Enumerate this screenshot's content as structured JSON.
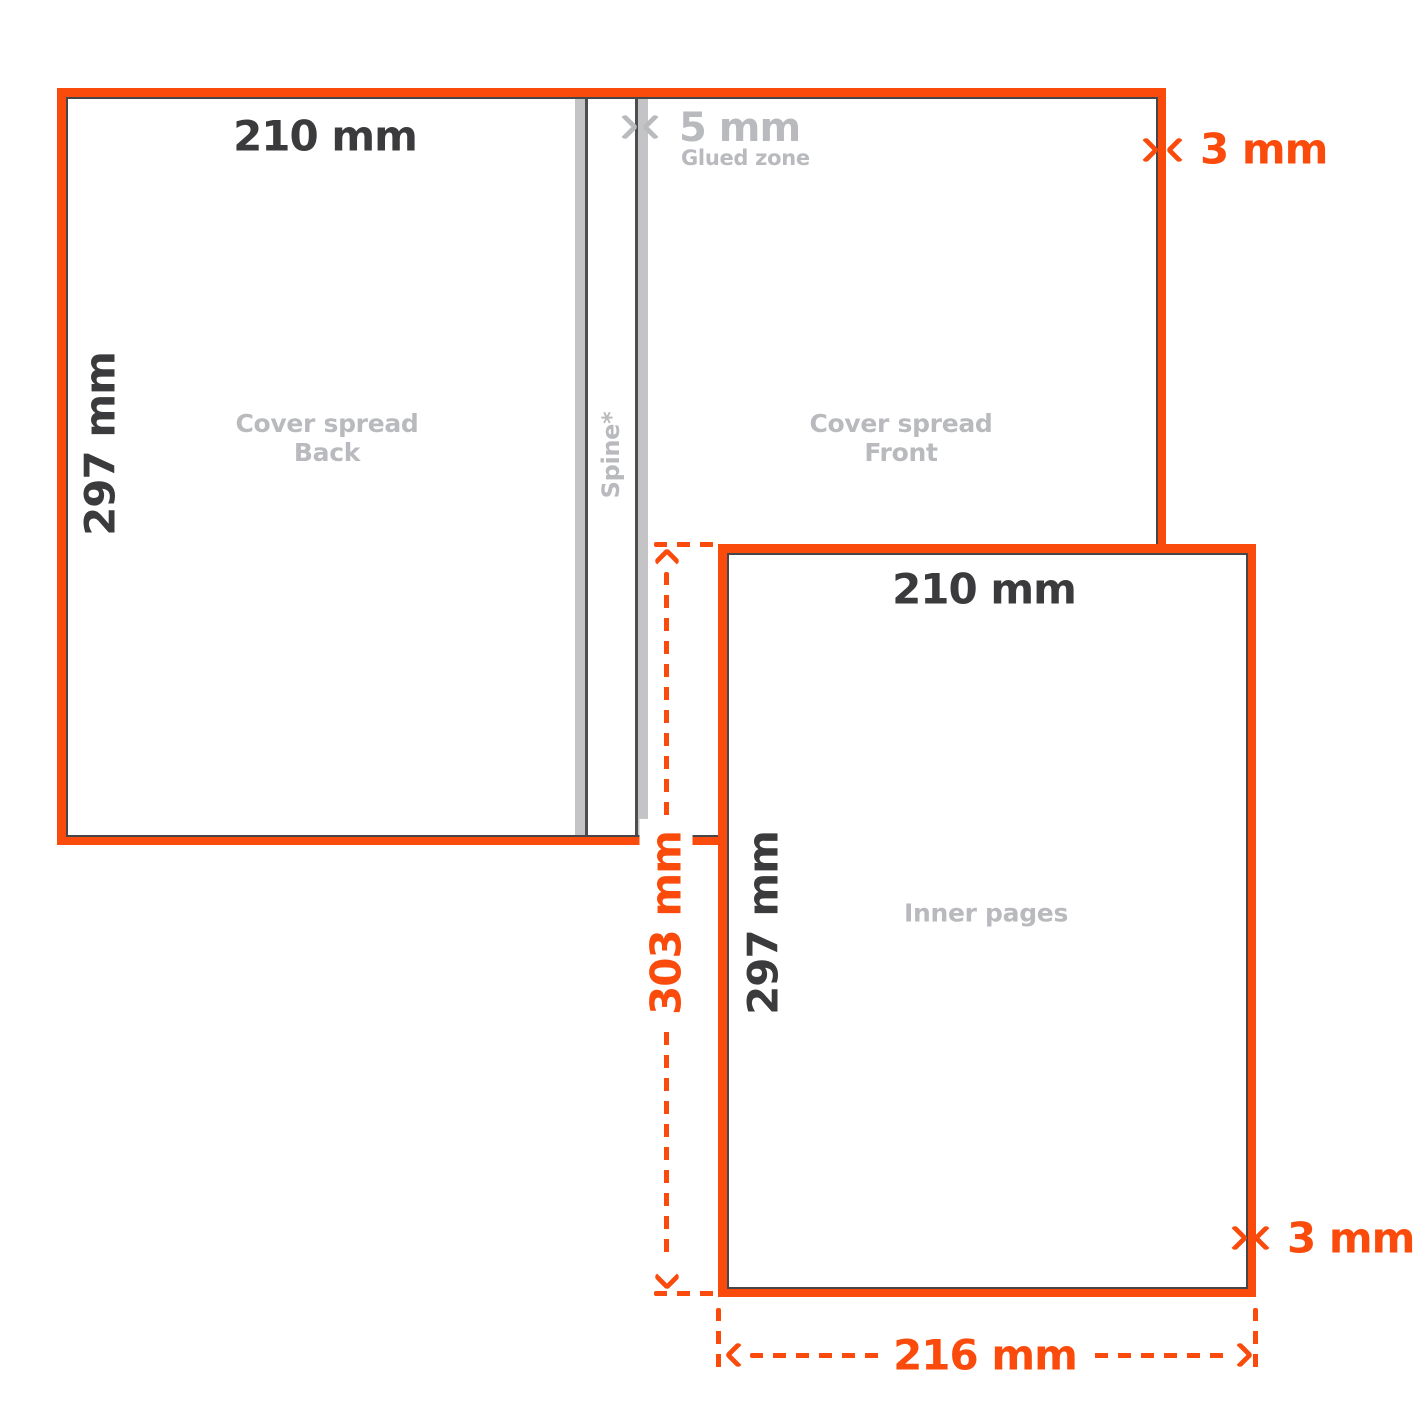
{
  "colors": {
    "accent_orange": "#FA4B0C",
    "dark_text": "#3B3B3D",
    "muted_gray": "#B8BABD",
    "strip_fill": "#C4C4C6",
    "strip_edge": "#4D4D50",
    "trim_line": "#46464A"
  },
  "cover_spread": {
    "width_label": "210 mm",
    "height_label": "297 mm",
    "back": {
      "line1": "Cover spread",
      "line2": "Back"
    },
    "front": {
      "line1": "Cover spread",
      "line2": "Front"
    },
    "spine_label": "Spine*",
    "glued_zone": {
      "size_label": "5 mm",
      "name_label": "Glued zone"
    },
    "bleed_label": "3 mm"
  },
  "inner_pages": {
    "width_label": "210 mm",
    "height_label": "297 mm",
    "name_label": "Inner pages",
    "bleed_label": "3 mm"
  },
  "dimensions": {
    "total_height_label": "303 mm",
    "total_width_label": "216 mm"
  }
}
